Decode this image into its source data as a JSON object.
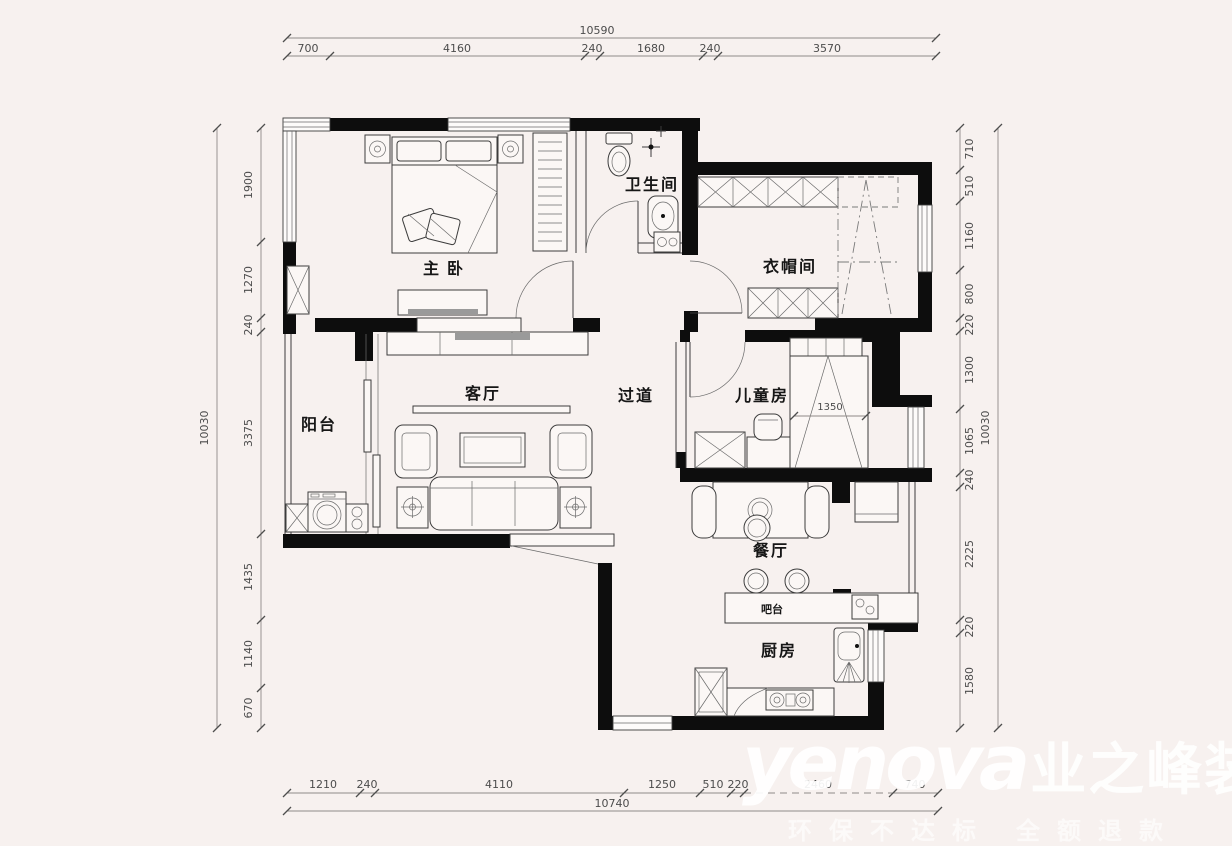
{
  "colors": {
    "background": "#f7f1ef",
    "wall": "#0d0d0d",
    "line": "#3c3c3c",
    "dimension_text": "#4c4c4c",
    "watermark": "#ffffff"
  },
  "rooms": {
    "master_bedroom": "主 卧",
    "bathroom": "卫生间",
    "cloakroom": "衣帽间",
    "hallway": "过道",
    "children_room": "儿童房",
    "living_room": "客厅",
    "balcony": "阳台",
    "dining_room": "餐厅",
    "bar_counter": "吧台",
    "kitchen": "厨房"
  },
  "dims": {
    "top": {
      "total": "10590",
      "segs": [
        "700",
        "4160",
        "240",
        "1680",
        "240",
        "3570"
      ]
    },
    "bottom": {
      "total": "10740",
      "segs": [
        "1210",
        "240",
        "4110",
        "1250",
        "510",
        "220",
        "2460",
        "740"
      ]
    },
    "left": {
      "total": "10030",
      "segs": [
        "1900",
        "1270",
        "240",
        "3375",
        "1435",
        "1140",
        "670"
      ]
    },
    "right": {
      "total": "10030",
      "segs": [
        "710",
        "510",
        "1160",
        "800",
        "220",
        "1300",
        "1065",
        "240",
        "2225",
        "220",
        "1580"
      ]
    },
    "children_bed_width": "1350"
  },
  "watermark": {
    "latin": "yenova",
    "brand": "业之峰装饰",
    "tagline": "环保不达标 全额退款"
  }
}
